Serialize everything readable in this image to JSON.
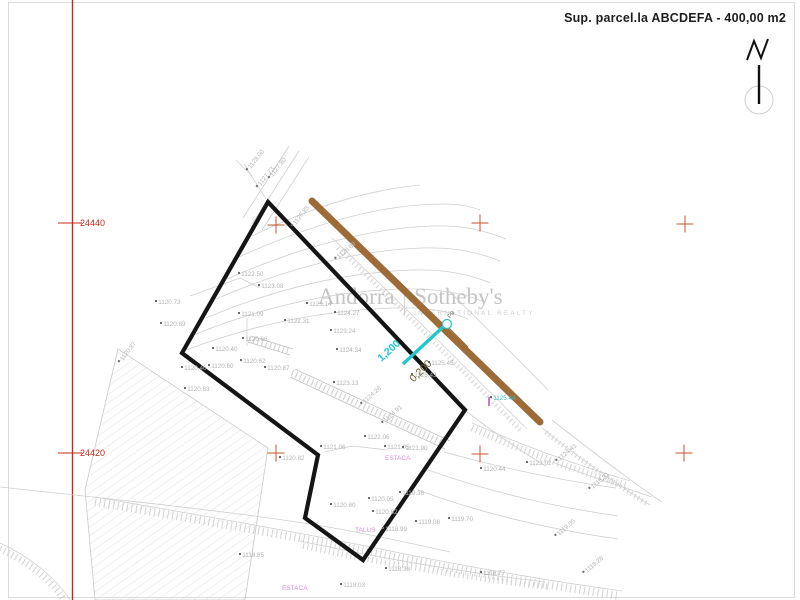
{
  "title": {
    "text": "Sup. parcel.la ABCDEFA - 400,00 m2"
  },
  "watermark": {
    "brand_left": "Andorra",
    "brand_right": "Sotheby's",
    "subtitle": "INTERNATIONAL REALTY"
  },
  "grid": {
    "axis_labels": [
      {
        "t": "24440",
        "x": 80,
        "y": 219
      },
      {
        "t": "24420",
        "x": 80,
        "y": 449
      }
    ],
    "crosses": [
      {
        "x": 276,
        "y": 225
      },
      {
        "x": 480,
        "y": 223
      },
      {
        "x": 685,
        "y": 224
      },
      {
        "x": 276,
        "y": 453
      },
      {
        "x": 480,
        "y": 454
      },
      {
        "x": 684,
        "y": 453
      }
    ]
  },
  "annotations": [
    {
      "t": "ESTACA",
      "x": 385,
      "y": 456,
      "c": "#df8ed9",
      "fs": 6.5
    },
    {
      "t": "TALUS",
      "x": 355,
      "y": 528,
      "c": "#df8ed9",
      "fs": 6.5
    },
    {
      "t": "ESTACA",
      "x": 282,
      "y": 586,
      "c": "#df8ed9",
      "fs": 6.5
    },
    {
      "t": "P9",
      "x": 447,
      "y": 316,
      "r": -50,
      "c": "#6b6b6b",
      "fs": 6
    },
    {
      "t": "1,200",
      "x": 376,
      "y": 356,
      "r": -42,
      "c": "#22c7ce",
      "fs": 10.5,
      "w": "bold"
    },
    {
      "t": "0,200",
      "x": 408,
      "y": 377,
      "r": -45,
      "c": "#6e5a2e",
      "fs": 10.5
    }
  ],
  "point_labels": [
    {
      "t": "1120.73",
      "x": 155,
      "y": 300
    },
    {
      "t": "1120.69",
      "x": 160,
      "y": 322
    },
    {
      "t": "1122.50",
      "x": 238,
      "y": 272
    },
    {
      "t": "1123.08",
      "x": 258,
      "y": 284
    },
    {
      "t": "1121.09",
      "x": 238,
      "y": 312
    },
    {
      "t": "1123.14",
      "x": 306,
      "y": 302
    },
    {
      "t": "1124.27",
      "x": 334,
      "y": 311
    },
    {
      "t": "1122.31",
      "x": 284,
      "y": 319
    },
    {
      "t": "1123.24",
      "x": 330,
      "y": 329
    },
    {
      "t": "1120.66",
      "x": 242,
      "y": 337
    },
    {
      "t": "1120.40",
      "x": 212,
      "y": 347
    },
    {
      "t": "1120.60",
      "x": 208,
      "y": 364
    },
    {
      "t": "1120.46",
      "x": 181,
      "y": 366
    },
    {
      "t": "1120.62",
      "x": 240,
      "y": 359
    },
    {
      "t": "1120.87",
      "x": 264,
      "y": 366
    },
    {
      "t": "1120.83",
      "x": 184,
      "y": 387
    },
    {
      "t": "1124.34",
      "x": 336,
      "y": 348
    },
    {
      "t": "1123.13",
      "x": 333,
      "y": 381
    },
    {
      "t": "1125.45",
      "x": 428,
      "y": 361
    },
    {
      "t": "1125.43",
      "x": 411,
      "y": 373
    },
    {
      "t": "1125.44",
      "x": 490,
      "y": 396,
      "c": "#35b8c4"
    },
    {
      "t": "1121.06",
      "x": 320,
      "y": 445
    },
    {
      "t": "1120.82",
      "x": 279,
      "y": 456
    },
    {
      "t": "1122.06",
      "x": 364,
      "y": 435
    },
    {
      "t": "1121.05",
      "x": 384,
      "y": 445
    },
    {
      "t": "1121.90",
      "x": 402,
      "y": 446
    },
    {
      "t": "1120.80",
      "x": 330,
      "y": 503
    },
    {
      "t": "1120.05",
      "x": 368,
      "y": 497
    },
    {
      "t": "1119.36",
      "x": 399,
      "y": 491
    },
    {
      "t": "1120.82",
      "x": 372,
      "y": 510
    },
    {
      "t": "1118.99",
      "x": 382,
      "y": 527
    },
    {
      "t": "1119.08",
      "x": 415,
      "y": 520
    },
    {
      "t": "1119.70",
      "x": 448,
      "y": 517
    },
    {
      "t": "1120.44",
      "x": 480,
      "y": 467
    },
    {
      "t": "1123.02",
      "x": 526,
      "y": 461
    },
    {
      "t": "1118.85",
      "x": 239,
      "y": 553
    },
    {
      "t": "1118.03",
      "x": 340,
      "y": 583
    },
    {
      "t": "1118.38",
      "x": 385,
      "y": 567
    },
    {
      "t": "1118.77",
      "x": 480,
      "y": 571
    },
    {
      "t": "1128.00",
      "x": 248,
      "y": 168,
      "r": -52
    },
    {
      "t": "1127.80",
      "x": 270,
      "y": 176,
      "r": -52
    },
    {
      "t": "1127.73",
      "x": 258,
      "y": 185,
      "r": -52
    },
    {
      "t": "1126.85",
      "x": 293,
      "y": 224,
      "r": -52
    },
    {
      "t": "1126.89",
      "x": 336,
      "y": 257,
      "r": -40
    },
    {
      "t": "1120.87",
      "x": 120,
      "y": 360,
      "r": -52
    },
    {
      "t": "1124.26",
      "x": 362,
      "y": 402,
      "r": -42
    },
    {
      "t": "1124.91",
      "x": 383,
      "y": 421,
      "r": -42
    },
    {
      "t": "1124.41",
      "x": 557,
      "y": 459,
      "r": -40
    },
    {
      "t": "1118.31",
      "x": 590,
      "y": 487,
      "r": -40
    },
    {
      "t": "1119.05",
      "x": 556,
      "y": 534,
      "r": -40
    },
    {
      "t": "1118.28",
      "x": 584,
      "y": 571,
      "r": -40
    }
  ],
  "colors": {
    "grid_red": "#c5281c",
    "cross_red": "#c4532d",
    "road_brown": "#9c6b38",
    "dimension_cyan": "#22c7ce",
    "dimension_olive": "#6e5a2e",
    "stake_magenta": "#df8ed9",
    "elevation_gray": "#b3b3b3",
    "watermark_gray": "#c5c4c3",
    "boundary_black": "#151515"
  }
}
